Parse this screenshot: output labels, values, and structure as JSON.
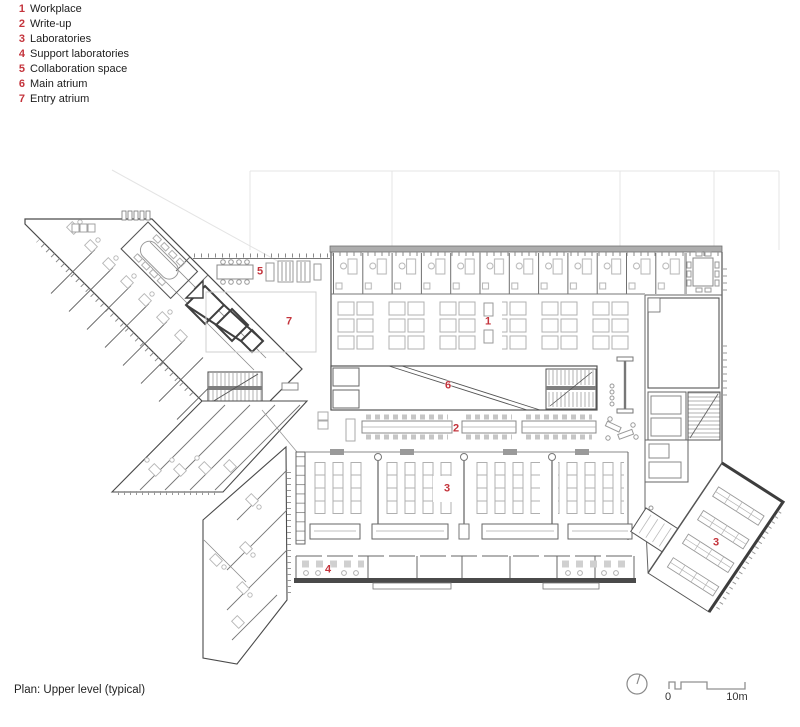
{
  "legend": {
    "items": [
      {
        "num": "1",
        "label": "Workplace"
      },
      {
        "num": "2",
        "label": "Write-up"
      },
      {
        "num": "3",
        "label": "Laboratories"
      },
      {
        "num": "4",
        "label": "Support laboratories"
      },
      {
        "num": "5",
        "label": "Collaboration space"
      },
      {
        "num": "6",
        "label": "Main atrium"
      },
      {
        "num": "7",
        "label": "Entry atrium"
      }
    ]
  },
  "plan_labels": {
    "collaboration_space": "5",
    "entry_atrium": "7",
    "workplace": "1",
    "main_atrium": "6",
    "write_up": "2",
    "laboratories": "3",
    "support_laboratories": "4",
    "laboratories_right": "3"
  },
  "caption": "Plan: Upper level (typical)",
  "scale_bar": {
    "start_label": "0",
    "end_label": "10m"
  },
  "colors": {
    "red": "#c4343c",
    "wall": "#555555",
    "furniture": "#b3b3b3"
  }
}
